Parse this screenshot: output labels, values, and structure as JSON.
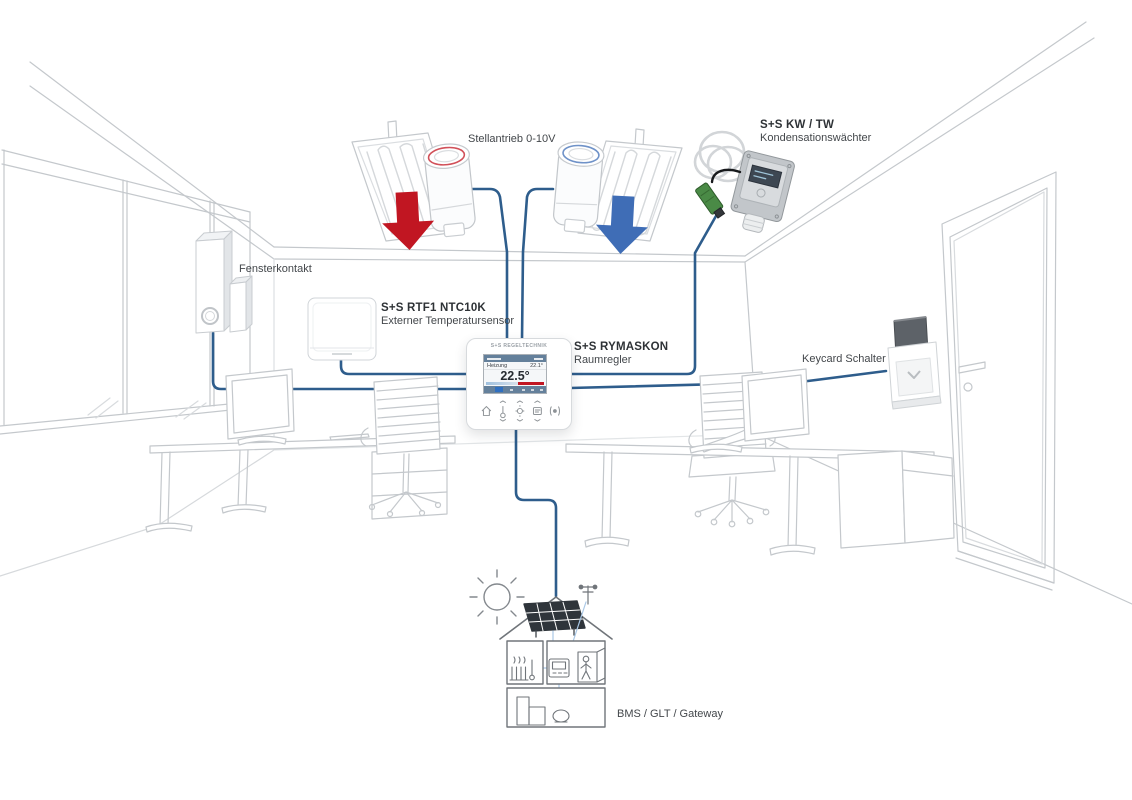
{
  "colors": {
    "wire": "#2e5d8c",
    "heating": "#c11622",
    "cooling": "#3f6db6",
    "probe_green": "#4a8a46",
    "line_art": "#c4c8cc"
  },
  "labels": {
    "actuator": {
      "text": "Stellantrieb 0-10V"
    },
    "condensation": {
      "title": "S+S KW / TW",
      "subtitle": "Kondensationswächter"
    },
    "window_contact": {
      "text": "Fensterkontakt"
    },
    "external_sensor": {
      "title": "S+S RTF1 NTC10K",
      "subtitle": "Externer Temperatursensor"
    },
    "room_controller": {
      "title": "S+S RYMASKON",
      "subtitle": "Raumregler"
    },
    "keycard": {
      "text": "Keycard Schalter"
    },
    "bms": {
      "text": "BMS / GLT / Gateway"
    }
  },
  "thermostat": {
    "brand": "S+S REGELTECHNIK",
    "mode_label": "Heizung",
    "mode_value": "22.1°",
    "temperature": "22.5°"
  }
}
